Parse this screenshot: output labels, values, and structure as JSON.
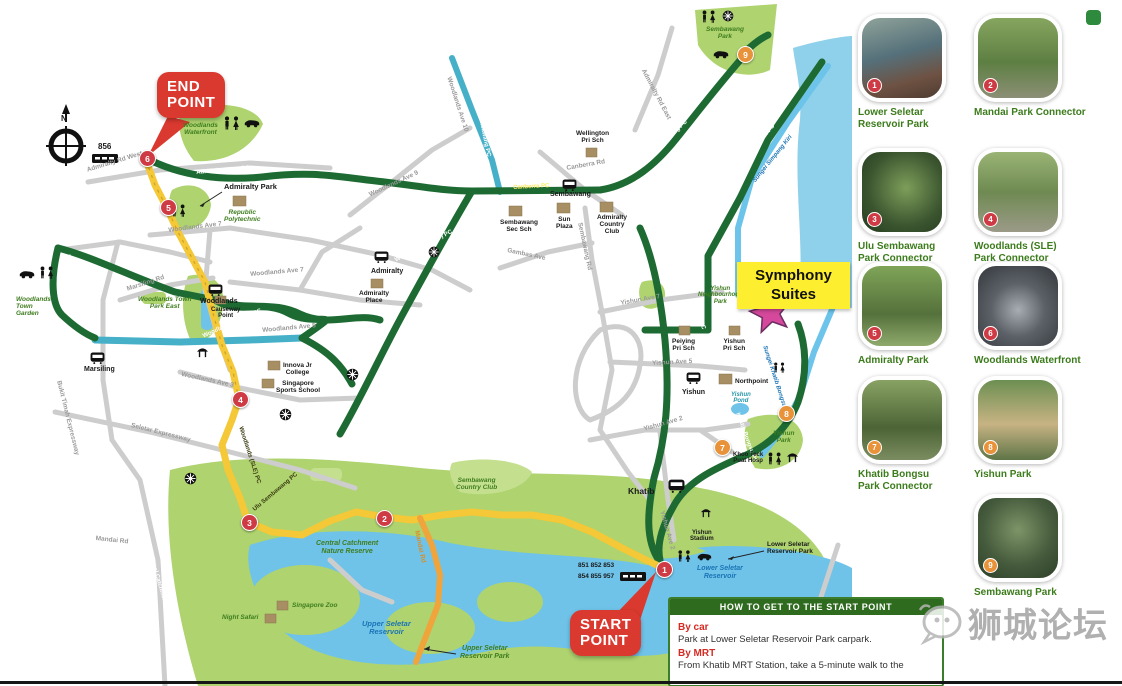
{
  "map": {
    "callouts": {
      "end_point": "END\nPOINT",
      "start_point": "START\nPOINT",
      "symphony": "Symphony\nSuites"
    },
    "marker_numbers": [
      "1",
      "2",
      "3",
      "4",
      "5",
      "6",
      "7",
      "8",
      "9"
    ],
    "labels": [
      "Woodlands\nWaterfront",
      "Admiralty West PC",
      "Admiralty Rd West",
      "Admiralty Park",
      "Republic\nPolytechnic",
      "856",
      "Woodlands Ave 7",
      "Marsiling PC",
      "Woodlands\nTown\nGarden",
      "Marsiling Rd",
      "Woodlands Town\nPark East",
      "Woodlands",
      "Causeway\nPoint",
      "Woodlands (N 3 E) PC",
      "Woodlands (Ave 3) PC",
      "Woodlands (Ave 9) PC",
      "Marsiling",
      "Bukit Timah Expressway",
      "Seletar Expressway",
      "Woodlands Ave 5",
      "Woodlands Ave 3",
      "Innova Jr\nCollege",
      "Singapore\nSports School",
      "Woodlands (SLE) PC",
      "Woodlands Ave 9",
      "Woodlands (Ave 7) PC",
      "Admiralty",
      "Admiralty\nPlace",
      "Sembawang PC",
      "Woodlands Ave 10",
      "Wellington\nPri Sch",
      "Admiralty Rd East",
      "Sembawang\nPark",
      "Canberra PC",
      "Canberra Rd",
      "Sembawang",
      "Sun\nPlaza",
      "Sembawang\nSec Sch",
      "Admiralty\nCountry\nClub",
      "Canberra Sembawang PC",
      "Simpang Kiri PC",
      "Sungei Simpang Kiri",
      "Gambas Ave",
      "Sembawang Rd",
      "Yishun Ave 7",
      "Yishun\nNeighbourhood\nPark",
      "Yishun PC",
      "Peiying\nPri Sch",
      "Yishun\nPri Sch",
      "Yishun Ave 5",
      "Yishun",
      "Northpoint",
      "Yishun\nPond",
      "Khatib Bongsu PC",
      "Sungei Khatib Bongsu",
      "Yishun\nPark",
      "Yishun Ave 2",
      "Khoo Teck\nPuat Hosp",
      "Khatib",
      "Yishun\nStadium",
      "Lower Seletar\nReservoir Park",
      "Lower Seletar\nReservoir",
      "851 852 853",
      "854 855 957",
      "Sembawang\nCountry Club",
      "Ulu Sembawang PC",
      "Mandai Rd",
      "Central Catchment PC",
      "Central Catchment\nNature Reserve",
      "Night Safari",
      "Singapore Zoo",
      "Upper Seletar\nReservoir",
      "Upper Seletar\nReservoir Park",
      "N"
    ]
  },
  "sidebar": {
    "items": [
      {
        "num": "1",
        "label": "Lower Seletar\nReservoir Park"
      },
      {
        "num": "2",
        "label": "Mandai Park Connector"
      },
      {
        "num": "3",
        "label": "Ulu Sembawang\nPark Connector"
      },
      {
        "num": "4",
        "label": "Woodlands (SLE)\nPark Connector"
      },
      {
        "num": "5",
        "label": "Admiralty Park"
      },
      {
        "num": "6",
        "label": "Woodlands Waterfront"
      },
      {
        "num": "7",
        "label": "Khatib Bongsu\nPark Connector"
      },
      {
        "num": "8",
        "label": "Yishun Park"
      },
      {
        "num": "9",
        "label": "Sembawang Park"
      }
    ]
  },
  "info_box": {
    "title": "HOW TO GET TO THE START POINT",
    "sections": [
      {
        "heading": "By car",
        "text": "Park at Lower Seletar Reservoir Park carpark."
      },
      {
        "heading": "By MRT",
        "text": "From Khatib MRT Station, take a 5-minute walk to the"
      }
    ]
  },
  "watermark": {
    "text": "狮城论坛"
  },
  "colors": {
    "route_green": "#1d6b33",
    "route_yellow": "#f4c836",
    "route_teal": "#46b0c9",
    "river_blue": "#6cc4ea",
    "park_green": "#aed36f",
    "road_gray": "#cdcdcd",
    "marker_red": "#cf3b44",
    "marker_orange": "#e8923a",
    "callout_red": "#d9392f",
    "symphony_yellow": "#fdee2f",
    "star_magenta": "#d5489b",
    "header_green": "#2e6b1f"
  }
}
